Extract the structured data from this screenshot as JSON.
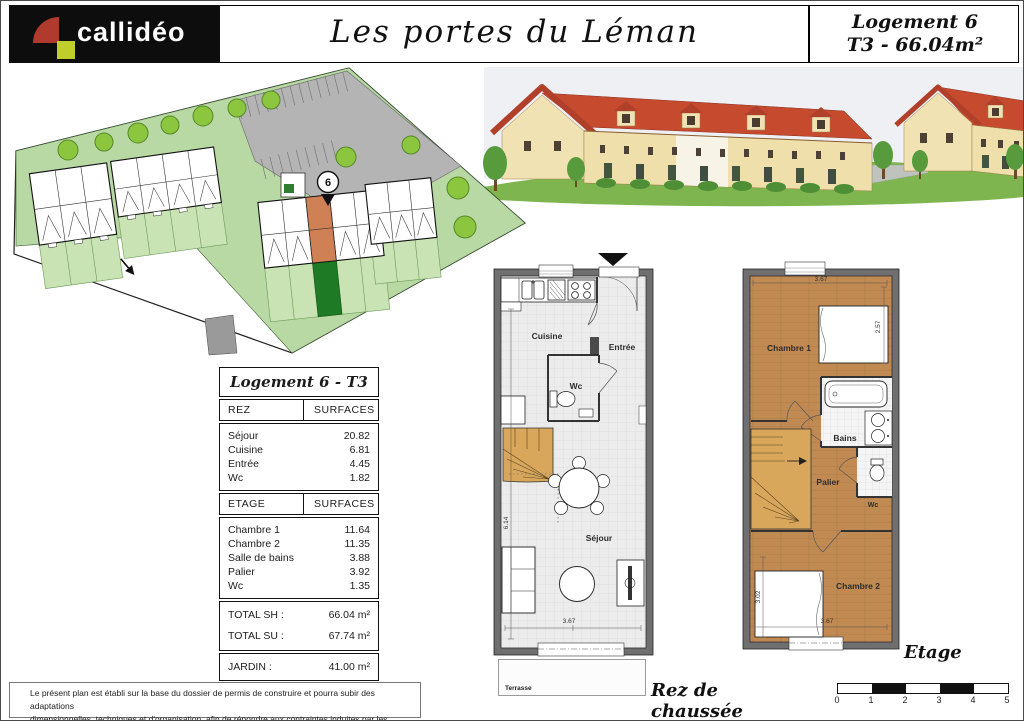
{
  "header": {
    "brand": "callidéo",
    "project_title": "Les portes du Léman",
    "unit_name": "Logement 6",
    "unit_spec": "T3 - 66.04m²"
  },
  "site_plan": {
    "unit_marker": "6"
  },
  "surfaces_table": {
    "title": "Logement 6 - T3",
    "rez_header": {
      "col1": "REZ",
      "col2": "SURFACES"
    },
    "rez_rows": [
      {
        "label": "Séjour",
        "value": "20.82"
      },
      {
        "label": "Cuisine",
        "value": "6.81"
      },
      {
        "label": "Entrée",
        "value": "4.45"
      },
      {
        "label": "Wc",
        "value": "1.82"
      }
    ],
    "etage_header": {
      "col1": "ETAGE",
      "col2": "SURFACES"
    },
    "etage_rows": [
      {
        "label": "Chambre 1",
        "value": "11.64"
      },
      {
        "label": "Chambre 2",
        "value": "11.35"
      },
      {
        "label": "Salle de bains",
        "value": "3.88"
      },
      {
        "label": "Palier",
        "value": "3.92"
      },
      {
        "label": "Wc",
        "value": "1.35"
      }
    ],
    "total_rows": [
      {
        "label": "TOTAL SH :",
        "value": "66.04 m²"
      },
      {
        "label": "TOTAL SU :",
        "value": "67.74 m²"
      }
    ],
    "jardin_row": {
      "label": "JARDIN :",
      "value": "41.00 m²"
    }
  },
  "ground_floor": {
    "caption": "Rez de chaussée",
    "terrace": "Terrasse",
    "rooms": {
      "cuisine": "Cuisine",
      "entree": "Entrée",
      "wc": "Wc",
      "sejour": "Séjour"
    },
    "dims": {
      "width": "3.67",
      "height": "6.14"
    }
  },
  "upper_floor": {
    "caption": "Etage",
    "rooms": {
      "chambre1": "Chambre 1",
      "bains": "Bains",
      "palier": "Palier",
      "wc": "Wc",
      "chambre2": "Chambre 2"
    },
    "dims": {
      "top": "3.67",
      "right": "2.57",
      "left": "3.02",
      "bottom": "3.67"
    }
  },
  "scale_bar": {
    "labels": [
      "0",
      "1",
      "2",
      "3",
      "4",
      "5"
    ]
  },
  "footer": {
    "line1": "Le présent plan est établi sur la base du dossier de permis de construire et pourra subir des adaptations",
    "line2": "dimensionnelles, techniques et d'organisation, afin de répondre aux contraintes induites par les études d'éxécution."
  },
  "colors": {
    "logo_red": "#b03a2e",
    "logo_green": "#bfce2b",
    "site_green": "#b9d9a4",
    "garden_light": "#c9e3b5",
    "garden_dark": "#1e7a24",
    "unit_highlight": "#d08055",
    "roof_red": "#c64a2e",
    "wood": "#c18a52",
    "stairs": "#d9a75b",
    "wall_gray": "#6f6f6f"
  }
}
